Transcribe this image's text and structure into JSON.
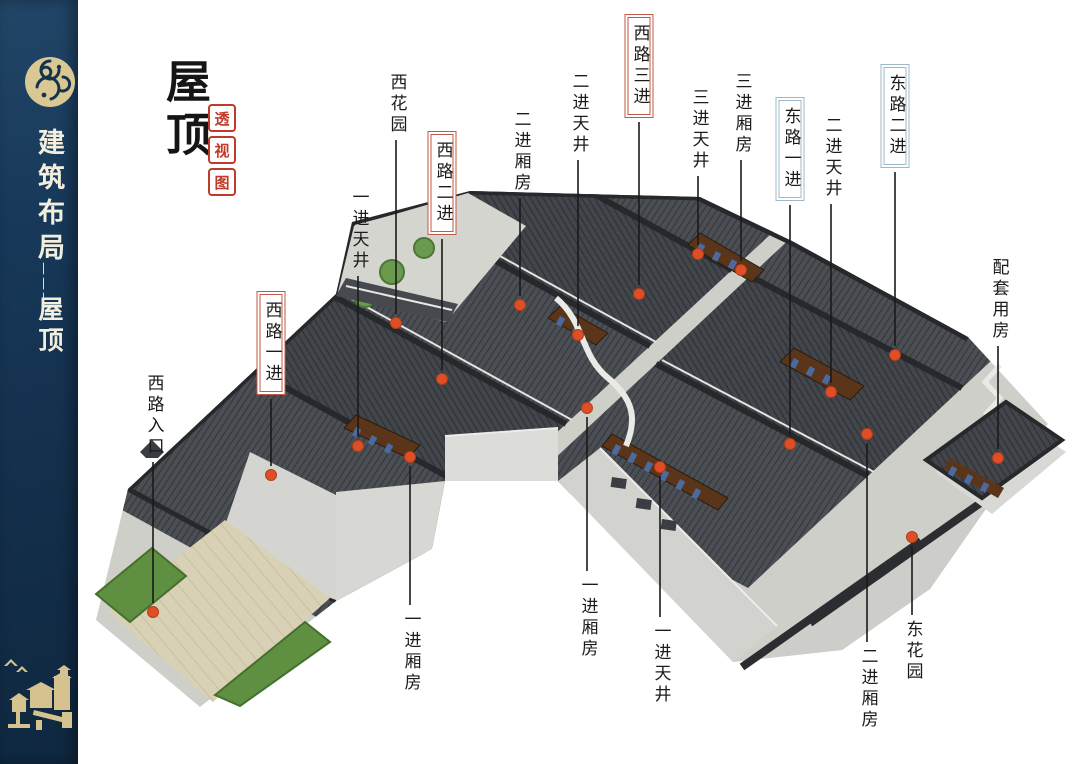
{
  "sidebar": {
    "title_vertical": "建筑布局",
    "separator": "———",
    "subtitle_vertical": "屋顶"
  },
  "header": {
    "title": "屋顶",
    "seal_characters": [
      "透",
      "视",
      "图"
    ]
  },
  "diagram": {
    "dot_color": "#de4f28",
    "box_colors": {
      "red-box": "#c05a46",
      "blue-box": "#9db9ce"
    },
    "labels": [
      {
        "text": "西花园",
        "style": "plain",
        "x": 396,
        "top": 73,
        "dot_y": 323
      },
      {
        "text": "一进天井",
        "style": "plain",
        "x": 358,
        "top": 188,
        "dot_y": 446
      },
      {
        "text": "西路一进",
        "style": "red-box",
        "x": 271,
        "top": 291,
        "dot_y": 475
      },
      {
        "text": "西路入口",
        "style": "plain",
        "x": 153,
        "top": 374,
        "dot_y": 612
      },
      {
        "text": "西路二进",
        "style": "red-box",
        "x": 442,
        "top": 131,
        "dot_y": 379
      },
      {
        "text": "二进厢房",
        "style": "plain",
        "x": 520,
        "top": 110,
        "dot_y": 305
      },
      {
        "text": "二进天井",
        "style": "plain",
        "x": 578,
        "top": 72,
        "dot_y": 335
      },
      {
        "text": "西路三进",
        "style": "red-box",
        "x": 639,
        "top": 14,
        "dot_y": 294
      },
      {
        "text": "三进天井",
        "style": "plain",
        "x": 698,
        "top": 88,
        "dot_y": 254
      },
      {
        "text": "三进厢房",
        "style": "plain",
        "x": 741,
        "top": 72,
        "dot_y": 270
      },
      {
        "text": "东路一进",
        "style": "blue-box",
        "x": 790,
        "top": 97,
        "dot_y": 444
      },
      {
        "text": "二进天井",
        "style": "plain",
        "x": 831,
        "top": 116,
        "dot_y": 392
      },
      {
        "text": "东路二进",
        "style": "blue-box",
        "x": 895,
        "top": 64,
        "dot_y": 355
      },
      {
        "text": "配套用房",
        "style": "plain",
        "x": 998,
        "top": 258,
        "dot_y": 458
      },
      {
        "text": "一进厢房",
        "style": "plain",
        "x": 410,
        "top": 610,
        "dot_y": 457
      },
      {
        "text": "一进厢房",
        "style": "plain",
        "x": 587,
        "top": 576,
        "dot_y": 408
      },
      {
        "text": "一进天井",
        "style": "plain",
        "x": 660,
        "top": 622,
        "dot_y": 467
      },
      {
        "text": "二进厢房",
        "style": "plain",
        "x": 867,
        "top": 647,
        "dot_y": 434
      },
      {
        "text": "东花园",
        "style": "plain",
        "x": 912,
        "top": 620,
        "dot_y": 537
      }
    ],
    "colors": {
      "roof": "#45494e",
      "roof_ridge": "#26282b",
      "wall": "#d6d6d2",
      "paving": "#dcd5ba",
      "hedge": "#5f8f40",
      "courtyard_wood": "#5a3519",
      "window_blue": "#4a6aa0",
      "seal_red": "#bf3a28",
      "sidebar_navy": "#16334e",
      "sidebar_gold": "#d9c894"
    }
  }
}
